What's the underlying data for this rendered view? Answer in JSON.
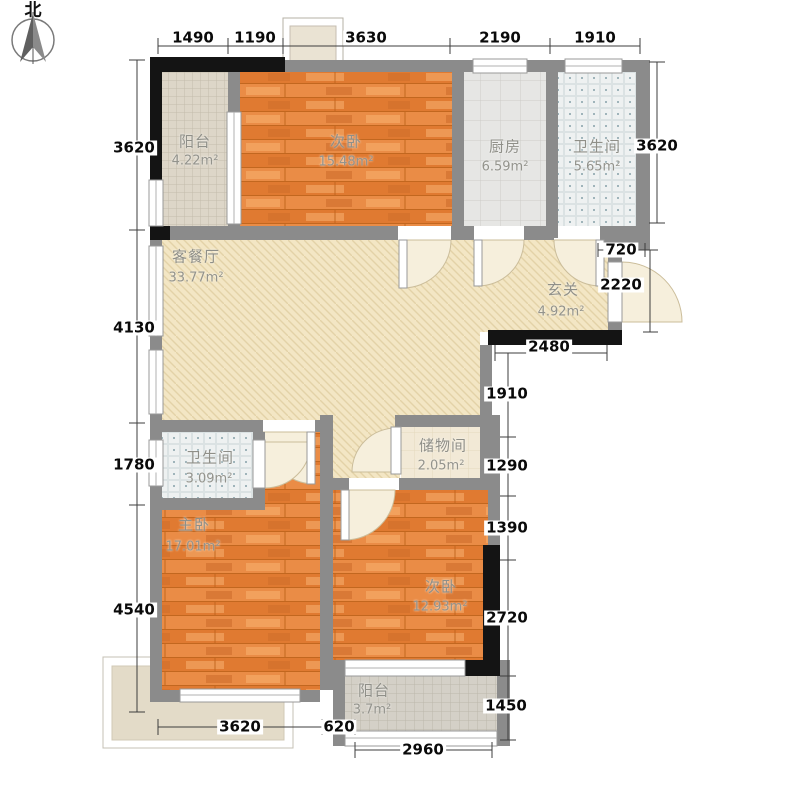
{
  "compass": {
    "north_label": "北"
  },
  "plan": {
    "rooms": [
      {
        "id": "balcony-north",
        "name": "阳台",
        "area": "4.22m²"
      },
      {
        "id": "bedroom-north",
        "name": "次卧",
        "area": "15.48m²"
      },
      {
        "id": "kitchen",
        "name": "厨房",
        "area": "6.59m²"
      },
      {
        "id": "bath-north",
        "name": "卫生间",
        "area": "5.65m²"
      },
      {
        "id": "living-dining",
        "name": "客餐厅",
        "area": "33.77m²"
      },
      {
        "id": "foyer",
        "name": "玄关",
        "area": "4.92m²"
      },
      {
        "id": "bath-mid",
        "name": "卫生间",
        "area": "3.09m²"
      },
      {
        "id": "storage",
        "name": "储物间",
        "area": "2.05m²"
      },
      {
        "id": "master-bedroom",
        "name": "主卧",
        "area": "17.01m²"
      },
      {
        "id": "bedroom-south",
        "name": "次卧",
        "area": "12.93m²"
      },
      {
        "id": "balcony-south",
        "name": "阳台",
        "area": "3.7m²"
      }
    ],
    "dims": {
      "top": [
        "1490",
        "1190",
        "3630",
        "2190",
        "1910"
      ],
      "left": [
        "3620",
        "4130",
        "1780",
        "4540"
      ],
      "right": [
        "3620",
        "720",
        "2220",
        "2480",
        "1910",
        "1290",
        "1390",
        "2720",
        "1450"
      ],
      "bottom": [
        "3620",
        "620",
        "2960"
      ]
    },
    "colors": {
      "wood": "#e8843d",
      "balcony_tile": "#ddd6c8",
      "kitchen_tile": "#e6e6e4",
      "bath_tile": "#eef1f1",
      "living_floor": "#f3e6c4",
      "wall_gray": "#8b8b8b",
      "wall_black": "#141414"
    }
  }
}
